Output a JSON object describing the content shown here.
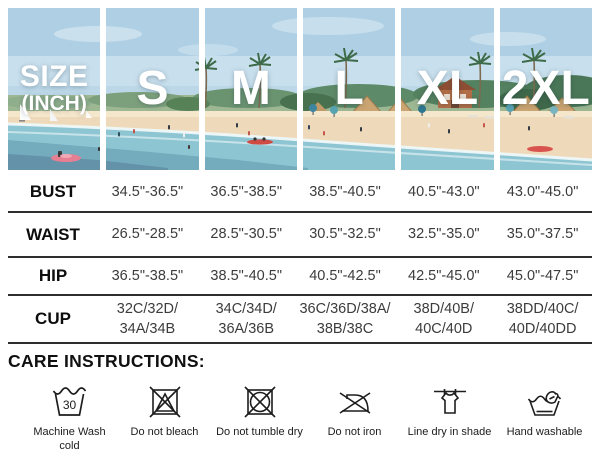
{
  "header": {
    "size_label_line1": "SIZE",
    "size_label_line2": "(INCH)",
    "sizes": [
      "S",
      "M",
      "L",
      "XL",
      "2XL"
    ]
  },
  "table": {
    "rows": [
      {
        "label": "BUST",
        "values": [
          "34.5\"-36.5\"",
          "36.5\"-38.5\"",
          "38.5\"-40.5\"",
          "40.5\"-43.0\"",
          "43.0\"-45.0\""
        ]
      },
      {
        "label": "WAIST",
        "values": [
          "26.5\"-28.5\"",
          "28.5\"-30.5\"",
          "30.5\"-32.5\"",
          "32.5\"-35.0\"",
          "35.0\"-37.5\""
        ]
      },
      {
        "label": "HIP",
        "values": [
          "36.5\"-38.5\"",
          "38.5\"-40.5\"",
          "40.5\"-42.5\"",
          "42.5\"-45.0\"",
          "45.0\"-47.5\""
        ]
      },
      {
        "label": "CUP",
        "values": [
          "32C/32D/\n34A/34B",
          "34C/34D/\n36A/36B",
          "36C/36D/38A/\n38B/38C",
          "38D/40B/\n40C/40D",
          "38DD/40C/\n40D/40DD"
        ]
      }
    ]
  },
  "care": {
    "heading": "CARE INSTRUCTIONS:",
    "items": [
      {
        "icon": "machine-wash-30-icon",
        "label": "Machine Wash cold\ndelicate cycle"
      },
      {
        "icon": "do-not-bleach-icon",
        "label": "Do not bleach"
      },
      {
        "icon": "do-not-tumble-dry-icon",
        "label": "Do not tumble dry"
      },
      {
        "icon": "do-not-iron-icon",
        "label": "Do not iron"
      },
      {
        "icon": "line-dry-shade-icon",
        "label": "Line dry in shade"
      },
      {
        "icon": "hand-wash-icon",
        "label": "Hand washable"
      }
    ],
    "wash_temperature": "30"
  },
  "colors": {
    "header_text": "#ffffff",
    "table_text": "#3c3c3c",
    "label_text": "#0d0d0d",
    "divider": "#2e2e2e"
  },
  "chart_data": {
    "type": "table",
    "title": "SIZE (INCH)",
    "columns": [
      "S",
      "M",
      "L",
      "XL",
      "2XL"
    ],
    "rows": [
      {
        "label": "BUST",
        "values": [
          "34.5\"-36.5\"",
          "36.5\"-38.5\"",
          "38.5\"-40.5\"",
          "40.5\"-43.0\"",
          "43.0\"-45.0\""
        ]
      },
      {
        "label": "WAIST",
        "values": [
          "26.5\"-28.5\"",
          "28.5\"-30.5\"",
          "30.5\"-32.5\"",
          "32.5\"-35.0\"",
          "35.0\"-37.5\""
        ]
      },
      {
        "label": "HIP",
        "values": [
          "36.5\"-38.5\"",
          "38.5\"-40.5\"",
          "40.5\"-42.5\"",
          "42.5\"-45.0\"",
          "45.0\"-47.5\""
        ]
      },
      {
        "label": "CUP",
        "values": [
          "32C/32D/34A/34B",
          "34C/34D/36A/36B",
          "36C/36D/38A/38B/38C",
          "38D/40B/40C/40D",
          "38DD/40C/40D/40DD"
        ]
      }
    ]
  }
}
